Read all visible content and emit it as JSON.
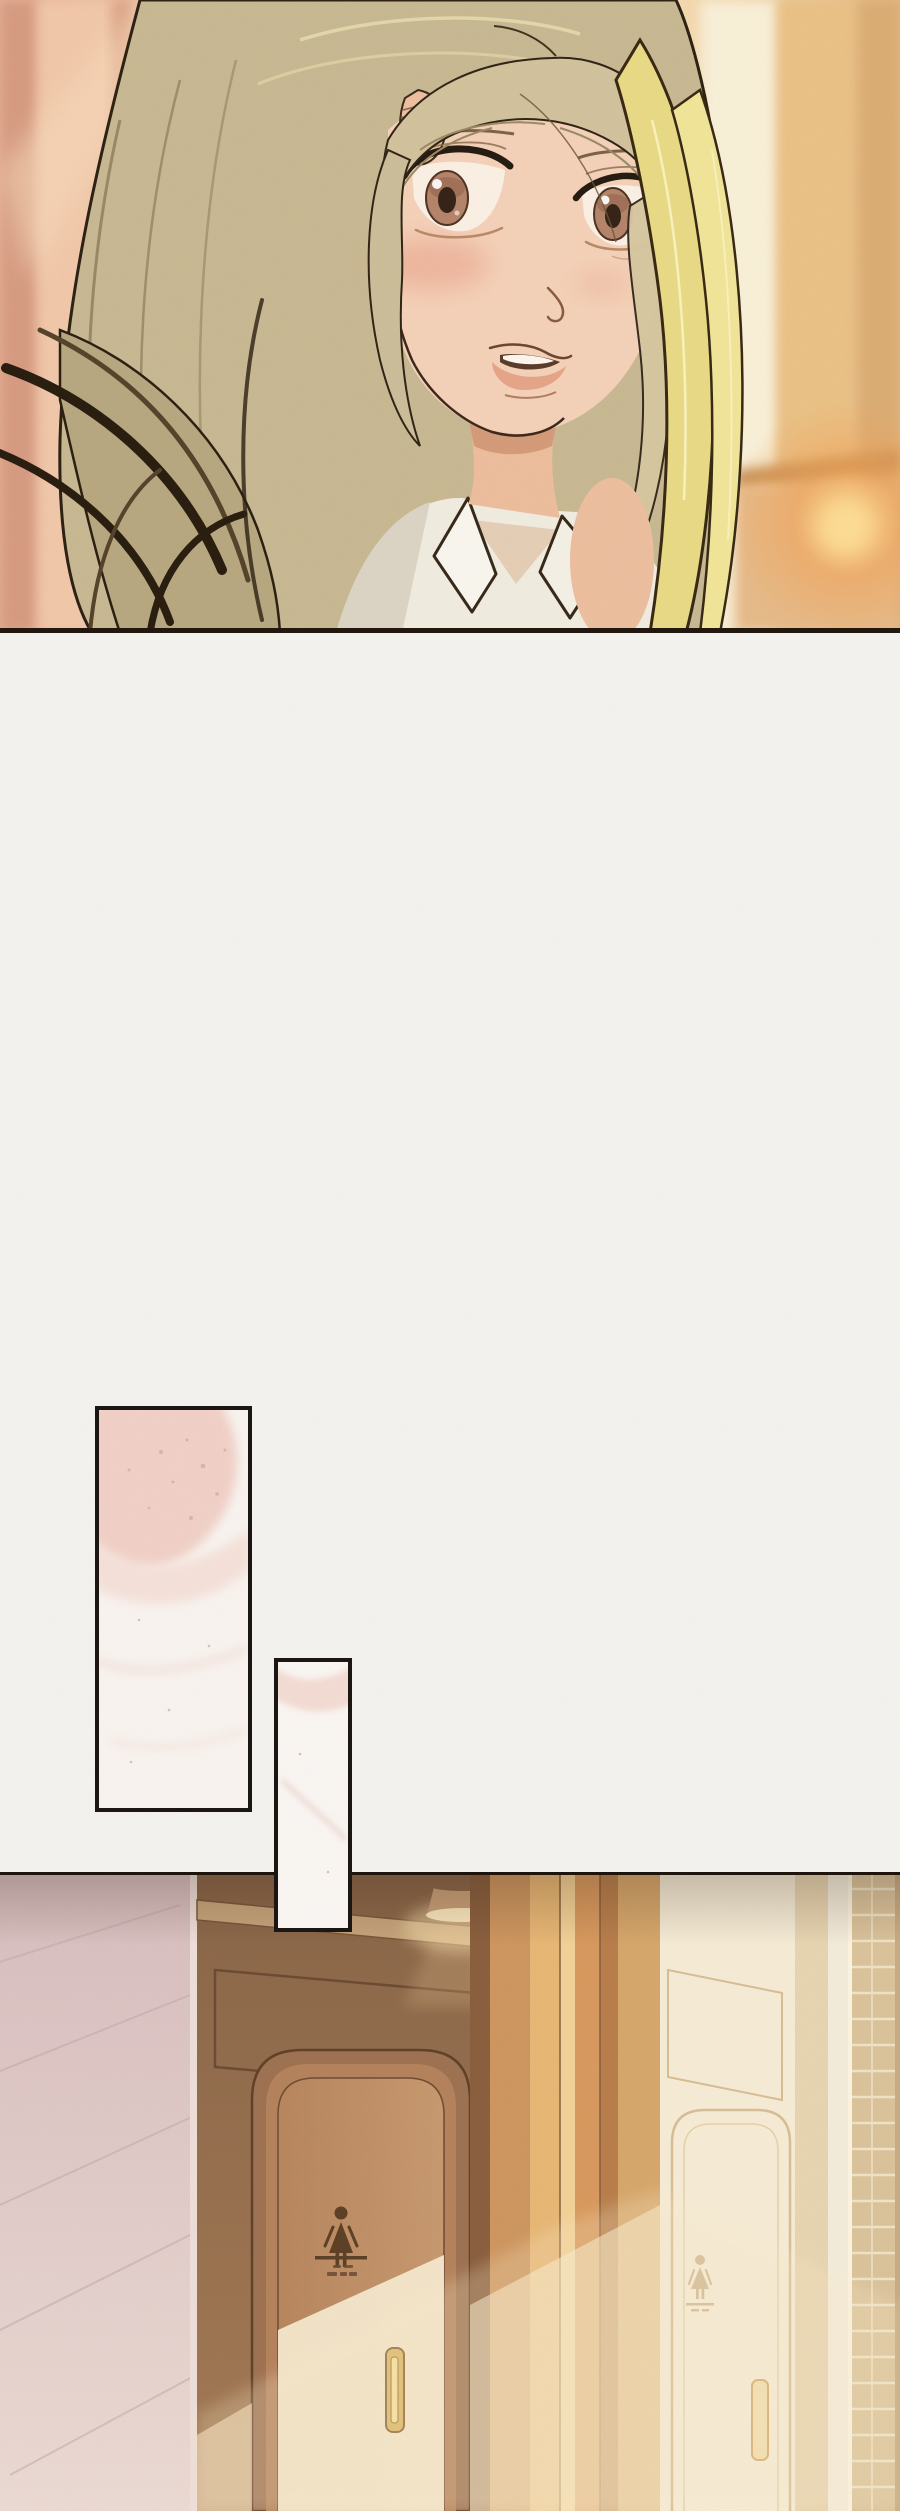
{
  "page": {
    "kind": "webtoon episode page",
    "background": "#f5f3ef",
    "width_px": 900,
    "height_px": 2511,
    "visible_text": "none — the only markings are tiny illegible scribbles under the restroom door pictograms"
  },
  "panels": {
    "portrait": {
      "alt": "Close-up of a young woman with long ash-blonde hair glancing back over her shoulder, lips parted, backlit by warm golden evening window light",
      "palette": {
        "window_pink": "#e9b49c",
        "window_cream": "#fbf2da",
        "window_gold": "#ecc387",
        "glow_orange": "#f4a458",
        "glow_core": "#ffd98a",
        "hair_ash": "#c9ba94",
        "hair_gold": "#eadc86",
        "outline_dark": "#2a1d11",
        "skin": "#f6d3ba",
        "blush": "#eba18a",
        "iris_brown": "#b5846b",
        "lips": "#e6a184",
        "shirt_white": "#f2eee2"
      }
    },
    "inset_closeup_top": {
      "alt": "Tall narrow inset panel: blurred pale-pink close-up texture with soft speckles",
      "border": "#191410",
      "fill": "#fbf6f2",
      "accent": "#f3d2c9"
    },
    "inset_closeup_bottom": {
      "alt": "Small narrow inset panel: faint pink-tinted blurred close-up texture",
      "border": "#191410",
      "fill": "#fcf8f5",
      "accent": "#f5ded6"
    },
    "restroom_scene": {
      "alt": "Warm-lit corridor at sunset: a wooden women's restroom door with carved female pictogram sign and brass pull handle, a second sun-washed door beyond, pink marble wall on the left and a tan tiled pillar on the far right",
      "door_sign": {
        "pictogram": "woman figure",
        "divider_bar": true,
        "caption_legible": false
      },
      "palette": {
        "marble_pink": "#e2cbc7",
        "wall_brown": "#97714f",
        "door_wood": "#bc8b61",
        "sunlit_cream": "#f9edd2",
        "frame_orange": "#e0a468",
        "handle_gold": "#ddb765",
        "bright_door": "#f8eed8",
        "tile_tan": "#dcc49c",
        "sign_brown": "#5c4026",
        "downlight_glow": "#f8dfae"
      }
    }
  }
}
